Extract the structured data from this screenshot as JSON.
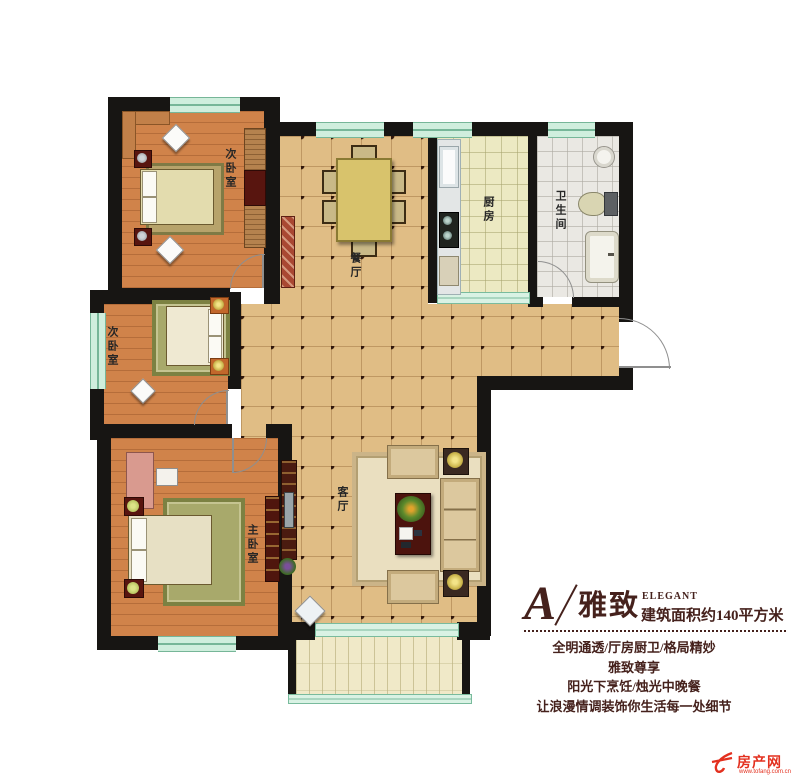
{
  "floor_plan": {
    "rooms": {
      "bedroom1": {
        "label": "次卧室"
      },
      "bedroom2": {
        "label": "次卧室"
      },
      "master_bedroom": {
        "label": "主卧室"
      },
      "dining": {
        "label": "餐厅"
      },
      "kitchen": {
        "label": "厨房"
      },
      "bathroom": {
        "label": "卫生间"
      },
      "living": {
        "label": "客厅"
      }
    },
    "colors": {
      "wall": "#171513",
      "wood_floor": "#d0834a",
      "hall_tile": "#e0bd85",
      "kitchen_tile": "#ece9c2",
      "bath_tile": "#eae8e3",
      "balcony_tile": "#f0e9c8",
      "window": "#cfeedd",
      "accent": "#45211c"
    }
  },
  "title_block": {
    "unit_letter": "A",
    "unit_name": "雅致",
    "unit_name_en": "ELEGANT",
    "area_line": "建筑面积约140平方米",
    "taglines": [
      "全明通透/厅房厨卫/格局精妙",
      "雅致尊享",
      "阳光下烹饪/烛光中晚餐",
      "让浪漫情调装饰你生活每一处细节"
    ]
  },
  "watermark": {
    "brand": "房产网",
    "url": "www.tofang.com.cn"
  }
}
